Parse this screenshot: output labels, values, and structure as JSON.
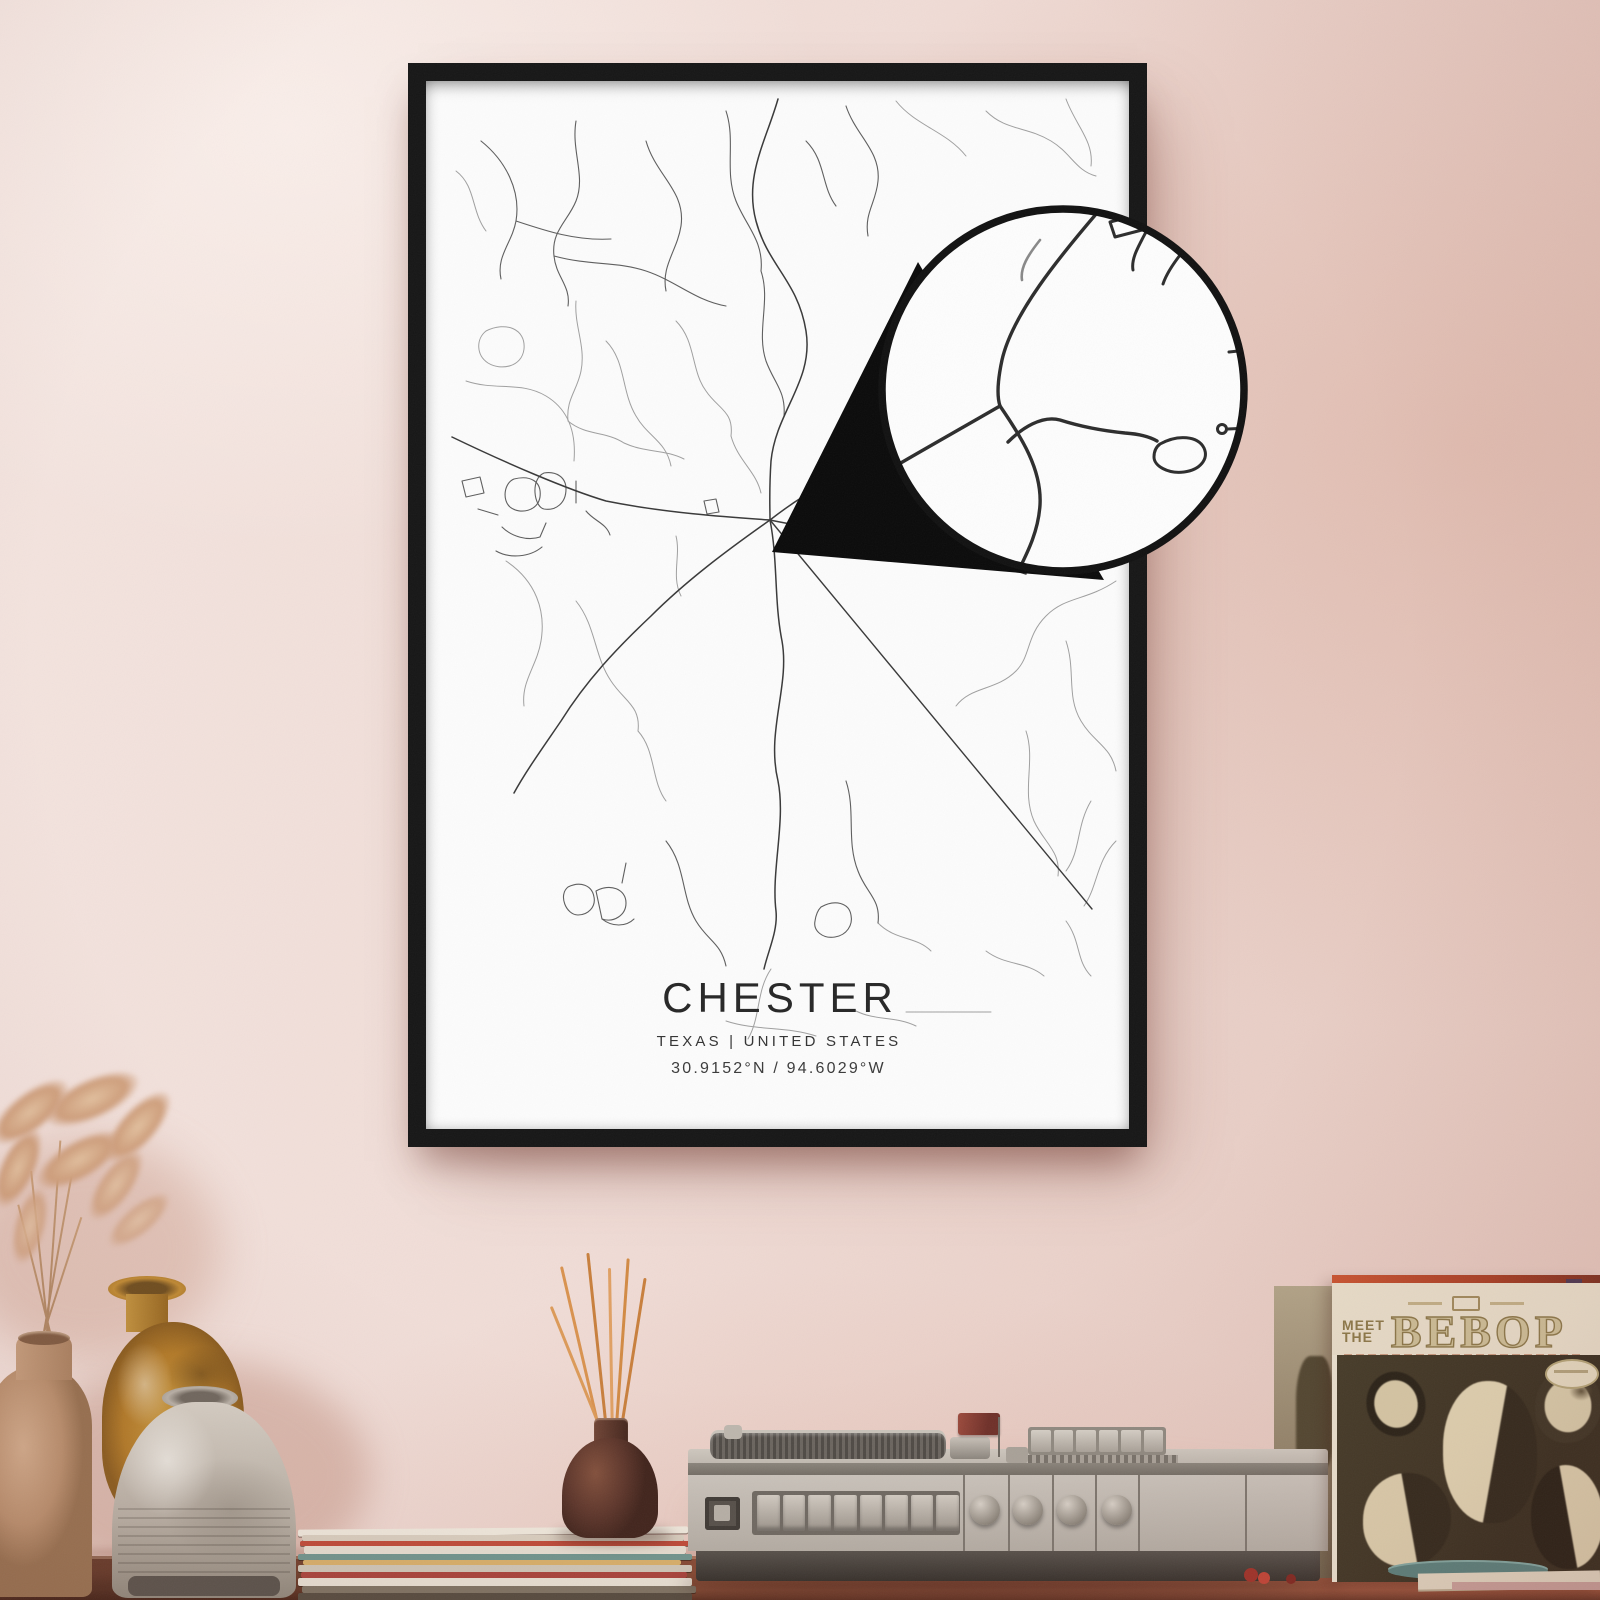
{
  "poster": {
    "title": "CHESTER",
    "subtitle": "TEXAS | UNITED STATES",
    "coordinates": "30.9152°N / 94.6029°W",
    "frame_color": "#161616",
    "paper_color": "#fcfcfc",
    "road_color_dark": "#383838",
    "road_color_light": "#9f9f9f"
  },
  "magnifier": {
    "ring_color": "#111111",
    "beak_color": "#0a0a0a",
    "paper_color": "#fdfdfd",
    "road_color": "#2c2c2c"
  },
  "record_sleeve": {
    "meet_line1": "MEET",
    "meet_line2": "THE",
    "title": "BEBOP",
    "stripe_color": "#bf4a2c",
    "header_color": "#e9dfcb",
    "title_fill": "#cdbf97",
    "title_outline": "#8a7748",
    "panel_color": "#38301f"
  },
  "record_player": {
    "body_color": "#c3bdb4",
    "base_color": "#47423c",
    "knob_count": 4,
    "pushbutton_count": 8
  },
  "decor": {
    "wall_color_left": "#f4e5e0",
    "wall_color_right": "#e3c4ba",
    "table_color": "#8a4a34",
    "incense_stick_color": "#d28a43",
    "bottle_color": "#5f392c",
    "vase_tan_color": "#c29b7c",
    "vase_yellow_color": "#b8842e",
    "vase_gray_color": "#c3bcb1",
    "grass_color": "#d3ab87"
  }
}
